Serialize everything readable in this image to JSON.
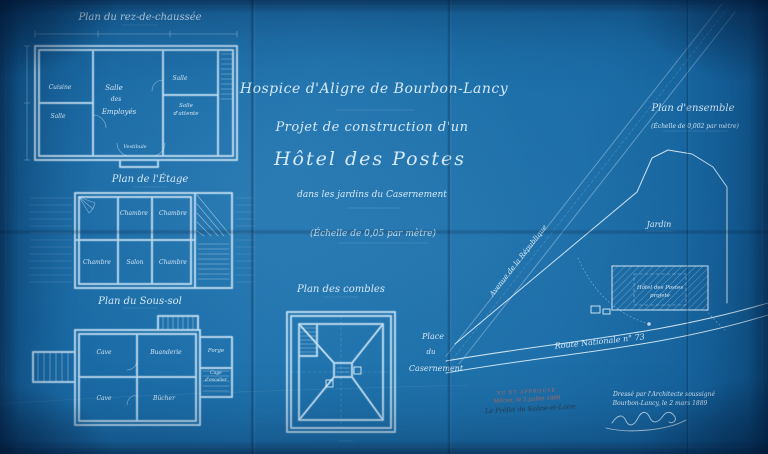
{
  "titles": {
    "line1": "Hospice d'Aligre de Bourbon-Lancy",
    "line2": "Projet de construction d'un",
    "line3": "Hôtel des Postes",
    "line4": "dans les jardins du Casernement",
    "scale": "(Échelle de 0,05 par mètre)"
  },
  "plans": {
    "rdc": {
      "title": "Plan du rez-de-chaussée",
      "rooms": {
        "cuisine": [
          "Cuisine"
        ],
        "salle_g": [
          "Salle"
        ],
        "employes": [
          "Salle",
          "des",
          "Employés"
        ],
        "salle_d": [
          "Salle"
        ],
        "attente": [
          "Salle",
          "d'attente"
        ],
        "vestibule": [
          "Vestibule"
        ]
      }
    },
    "etage": {
      "title": "Plan de l'Étage",
      "rooms": {
        "ch1": [
          "Chambre"
        ],
        "ch2": [
          "Chambre"
        ],
        "ch3": [
          "Chambre"
        ],
        "salon": [
          "Salon"
        ],
        "ch4": [
          "Chambre"
        ]
      }
    },
    "soussol": {
      "title": "Plan du Sous-sol",
      "rooms": {
        "cave1": [
          "Cave"
        ],
        "buanderie": [
          "Buanderie"
        ],
        "forge": [
          "Forge"
        ],
        "cave2": [
          "Cave"
        ],
        "bucher": [
          "Bûcher"
        ],
        "cage": [
          "Cage",
          "d'escalier"
        ]
      }
    },
    "combles": {
      "title": "Plan des combles"
    }
  },
  "site": {
    "title": "Plan d'ensemble",
    "scale": "(Échelle de 0,002 par mètre)",
    "avenue": "Avenue de la République",
    "jardin": "Jardin",
    "batiment": [
      "Hôtel des Postes",
      "projeté"
    ],
    "place": [
      "Place",
      "du",
      "Casernement"
    ],
    "route": "Route Nationale n° 73"
  },
  "approval": {
    "stamp1": "VU ET APPROUVÉ",
    "stamp2": "Mâcon, le 5 juillet 1889",
    "stamp3": "Le Préfet de Saône-et-Loire",
    "arch1": "Dressé par l'Architecte soussigné",
    "arch2": "Bourbon-Lancy, le 2 mars 1889"
  },
  "colors": {
    "paper": "#1a6aa5",
    "ink": "#dcedfa",
    "stamp_red": "#b06a55",
    "stamp_ink": "#283a4e"
  }
}
